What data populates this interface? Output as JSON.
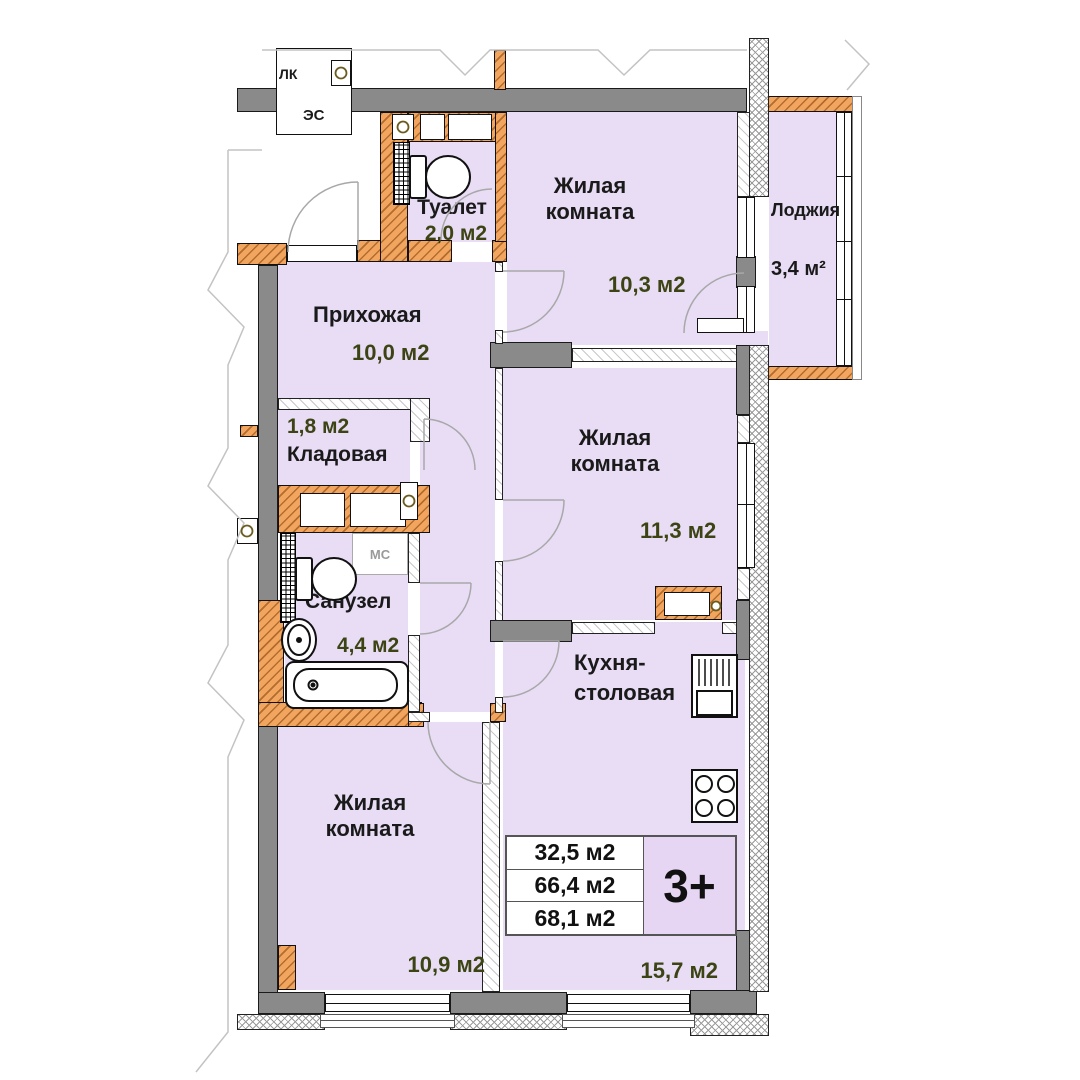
{
  "apartment": {
    "type_badge": "3+",
    "area_rows": [
      "32,5 м2",
      "66,4 м2",
      "68,1 м2"
    ],
    "rooms": {
      "toilet": {
        "name": "Туалет",
        "area": "2,0 м2"
      },
      "living1": {
        "name": "Жилая комната",
        "area": "10,3 м2"
      },
      "loggia": {
        "name": "Лоджия",
        "area": "3,4 м²"
      },
      "hallway": {
        "name": "Прихожая",
        "area": "10,0 м2"
      },
      "storage": {
        "name": "Кладовая",
        "area": "1,8 м2"
      },
      "living2": {
        "name": "Жилая комната",
        "area": "11,3 м2"
      },
      "bathroom": {
        "name": "Санузел",
        "area": "4,4 м2"
      },
      "kitchen": {
        "name_line1": "Кухня-",
        "name_line2": "столовая",
        "area": "15,7 м2"
      },
      "living3": {
        "name": "Жилая комната",
        "area": "10,9 м2"
      }
    },
    "service_labels": {
      "stairwell": "ЛК",
      "electrical": "ЭС",
      "washing_machine": "МС"
    },
    "colors": {
      "room_fill": "#e9ddf6",
      "badge_fill": "#e6d5f3",
      "wall_orange": "#f2a55f",
      "wall_gray": "#8a8a8a",
      "area_text": "#3c4414",
      "name_text": "#1a1a1a"
    }
  }
}
